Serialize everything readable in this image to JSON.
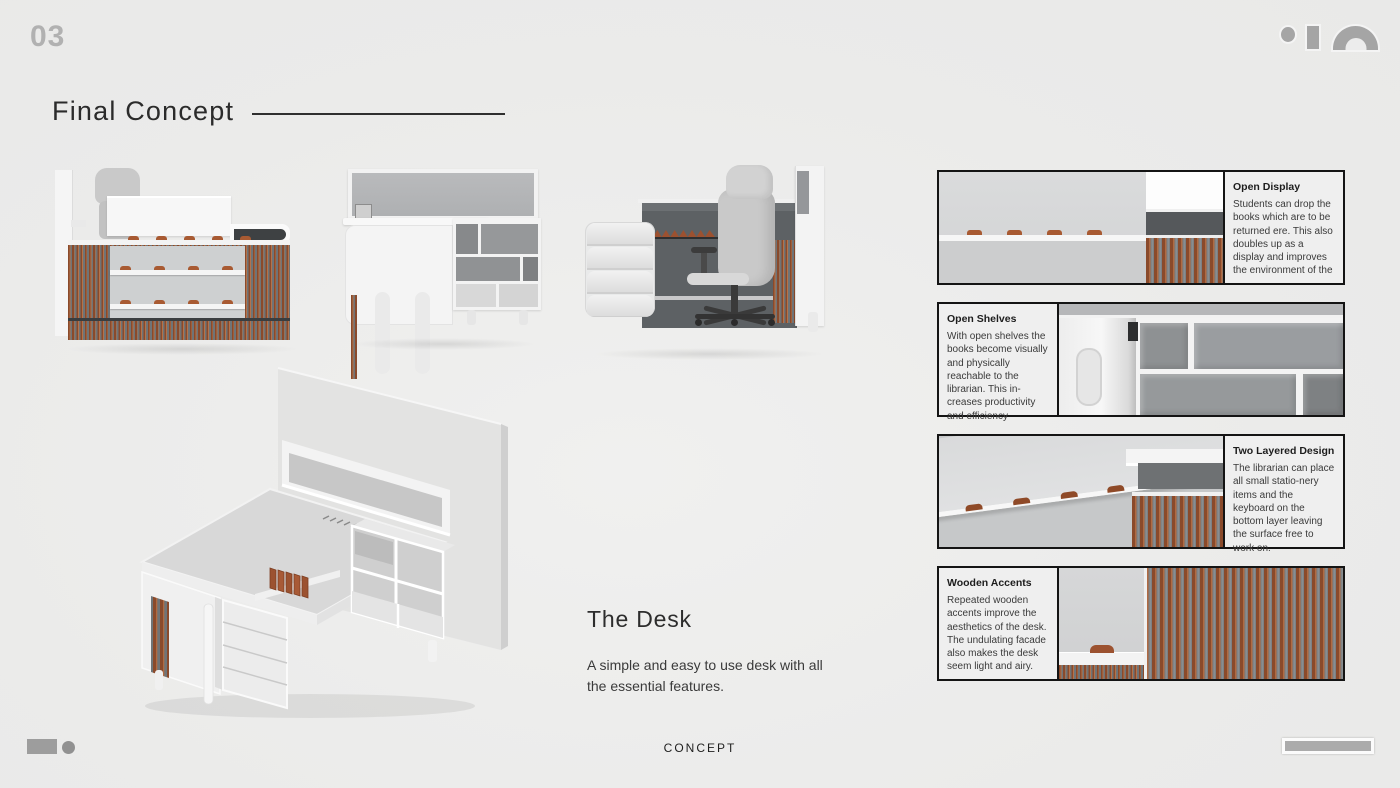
{
  "page": {
    "number": "03",
    "title": "Final Concept",
    "footer_label": "CONCEPT"
  },
  "desk_section": {
    "heading": "The Desk",
    "description": "A simple and easy to use desk with all the essential features."
  },
  "features": [
    {
      "title": "Open Display",
      "text": "Students can drop the books which are to be returned ere. This also doubles up as a display and improves the environment of the"
    },
    {
      "title": "Open Shelves",
      "text": "With open shelves the books become visually and physically reachable to the librarian. This in-creases productivity and efficiency"
    },
    {
      "title": "Two Layered Design",
      "text": "The librarian can place all small statio-nery items and the keyboard on the bottom layer leaving the surface free to work on."
    },
    {
      "title": "Wooden Accents",
      "text": "Repeated wooden accents improve the aesthetics of the desk. The undulating facade also makes the desk seem light and airy."
    }
  ],
  "renders": [
    {
      "name": "desk-front-view"
    },
    {
      "name": "desk-rear-view"
    },
    {
      "name": "desk-side-view-with-chair"
    },
    {
      "name": "desk-isometric-view"
    }
  ],
  "icons": {
    "brand_logo": "dot-bar-arch-shapes",
    "footer_left": "rectangle-and-dot",
    "footer_right": "progress-bar-shape"
  },
  "colors": {
    "background": "#ececec",
    "wood_accent": "#8a4a2b",
    "wood_highlight": "#b06a42",
    "slat_gray": "#73787b",
    "clip_orange": "#a85a32",
    "panel_border": "#141414",
    "text_dark": "#2b2b2b",
    "deco_gray": "#a5a5a5"
  }
}
